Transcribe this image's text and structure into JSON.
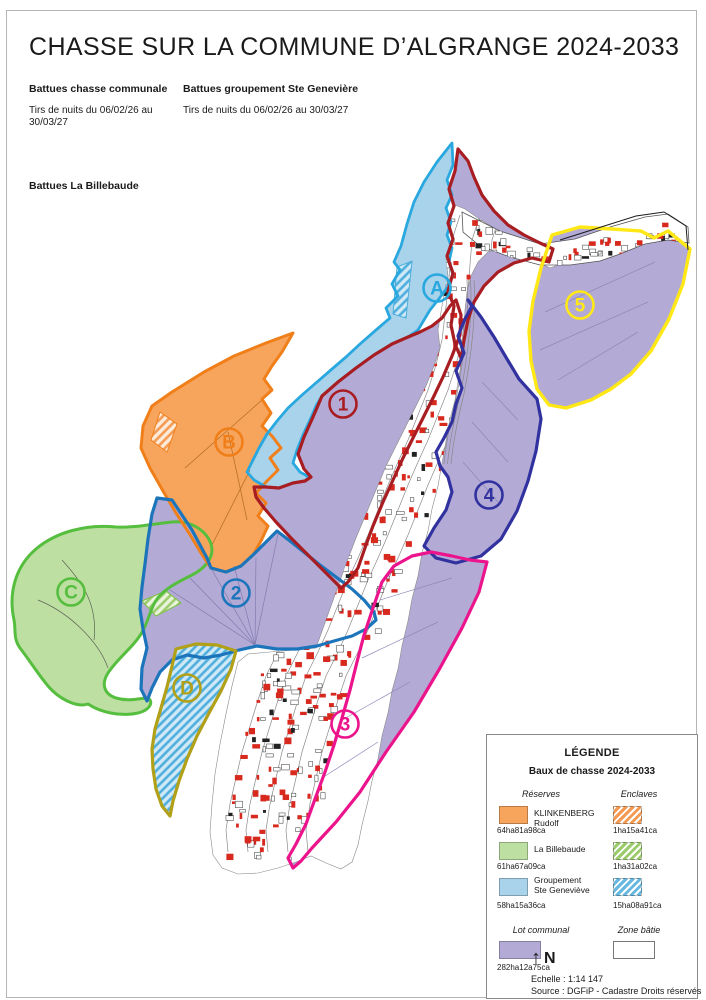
{
  "page": {
    "title": "CHASSE SUR LA COMMUNE D’ALGRANGE 2024-2033",
    "notes": {
      "communale_heading": "Battues chasse communale",
      "communale_text": "Tirs de nuits du 06/02/26 au 30/03/27",
      "groupement_heading": "Battues groupement Ste Genevière",
      "groupement_text": "Tirs de nuits du 06/02/26 au 30/03/27",
      "billebaude_heading": "Battues La Billebaude"
    }
  },
  "map": {
    "zone_labels": [
      {
        "label": "A",
        "color": "#29A8DF"
      },
      {
        "label": "B",
        "color": "#F07F1A"
      },
      {
        "label": "C",
        "color": "#56BE3F"
      },
      {
        "label": "D",
        "color": "#B1A018"
      },
      {
        "label": "1",
        "color": "#A81D22"
      },
      {
        "label": "2",
        "color": "#1C75BB"
      },
      {
        "label": "3",
        "color": "#EC148C"
      },
      {
        "label": "4",
        "color": "#31319F"
      },
      {
        "label": "5",
        "color": "#FFE815"
      }
    ],
    "fill_colors": {
      "lot_communal": "#B3ABD6",
      "groupement": "#A9D3EA",
      "klinkenberg": "#F7A55C",
      "billebaude": "#BEDFA2",
      "zone_batie": "#FFFFFF",
      "building": "#D8291F"
    }
  },
  "legend": {
    "title": "LÉGENDE",
    "subtitle": "Baux de chasse 2024-2033",
    "reserves_heading": "Réserves",
    "enclaves_heading": "Enclaves",
    "reserves": [
      {
        "name": "KLINKENBERG Rudolf",
        "area": "64ha81a98ca",
        "color": "#F7A55C",
        "enclave_area": "1ha15a41ca"
      },
      {
        "name": "La Billebaude",
        "area": "61ha67a09ca",
        "color": "#BEDFA2",
        "enclave_area": "1ha31a02ca"
      },
      {
        "name": "Groupement Ste Geneviève",
        "area": "58ha15a36ca",
        "color": "#A9D3EA",
        "enclave_area": "15ha08a91ca"
      }
    ],
    "lot_heading": "Lot communal",
    "lot_area": "282ha12a75ca",
    "lot_color": "#B3ABD6",
    "zone_batie_heading": "Zone bâtie",
    "north_label": "N",
    "scale_text": "Echelle : 1:14 147",
    "source_text": "Source : DGFiP - Cadastre Droits réservés"
  }
}
